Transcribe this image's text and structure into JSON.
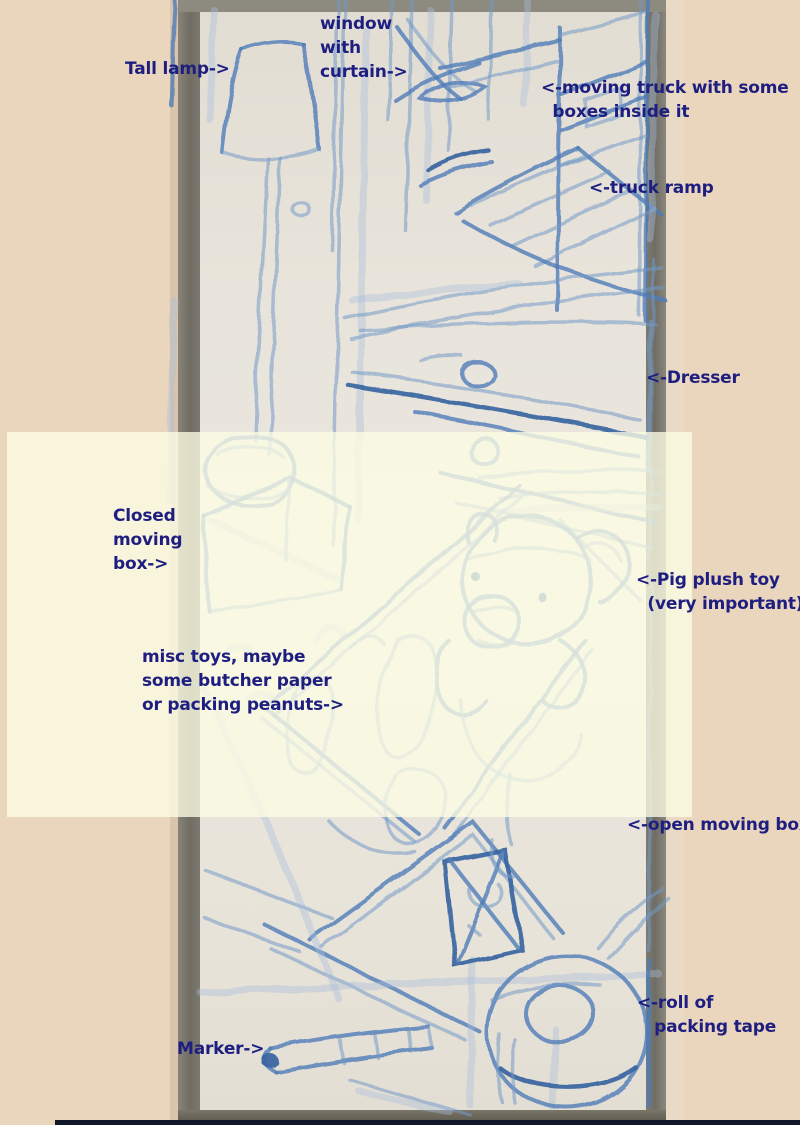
{
  "annotations": {
    "tall_lamp": {
      "text": "Tall lamp->"
    },
    "window": {
      "text": "window\nwith\ncurtain->"
    },
    "moving_truck": {
      "text": "<-moving truck with some\n  boxes inside it"
    },
    "truck_ramp": {
      "text": "<-truck ramp"
    },
    "dresser": {
      "text": "<-Dresser"
    },
    "closed_box": {
      "text": "Closed\nmoving\nbox->"
    },
    "pig_plush": {
      "text": "<-Pig plush toy\n  (very important)"
    },
    "misc_toys": {
      "text": "misc toys, maybe\nsome butcher paper\nor packing peanuts->"
    },
    "open_box": {
      "text": "<-open moving box"
    },
    "packing_tape": {
      "text": "<-roll of\n   packing tape"
    },
    "marker": {
      "text": "Marker->"
    }
  },
  "colors": {
    "background": "#ead5bd",
    "annotation_ink": "#1e1e80",
    "crayon_blue": "#4f7cb8",
    "paper": "#e8e4db",
    "frame_gray": "#6f6d64",
    "highlight_band": "#fdfce4",
    "bottom_strip": "#111827"
  }
}
